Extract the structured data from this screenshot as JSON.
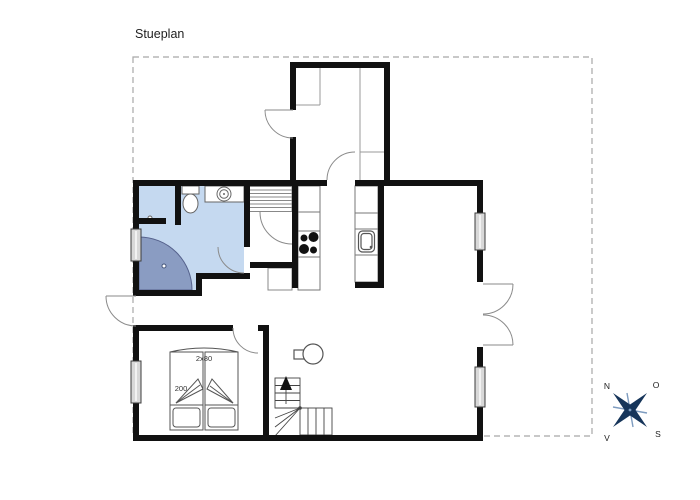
{
  "title": "Stueplan",
  "labels": {
    "bed_width": "2x80",
    "bed_length": "200"
  },
  "compass": {
    "north": "N",
    "east": "O",
    "south": "S",
    "west": "V"
  },
  "colors": {
    "wall": "#111111",
    "bathroom_floor": "#c5d9f0",
    "shower_floor": "#8a9cc2",
    "shower_edge": "#55618c",
    "window_glass": "#d8d8d8",
    "door_arc": "#8a8a8a",
    "fixture_line": "#666666",
    "stair_line": "#444444",
    "dashed_boundary": "#a8a8a8",
    "compass_star": "#16355a",
    "compass_cross": "#7e9cc0"
  }
}
